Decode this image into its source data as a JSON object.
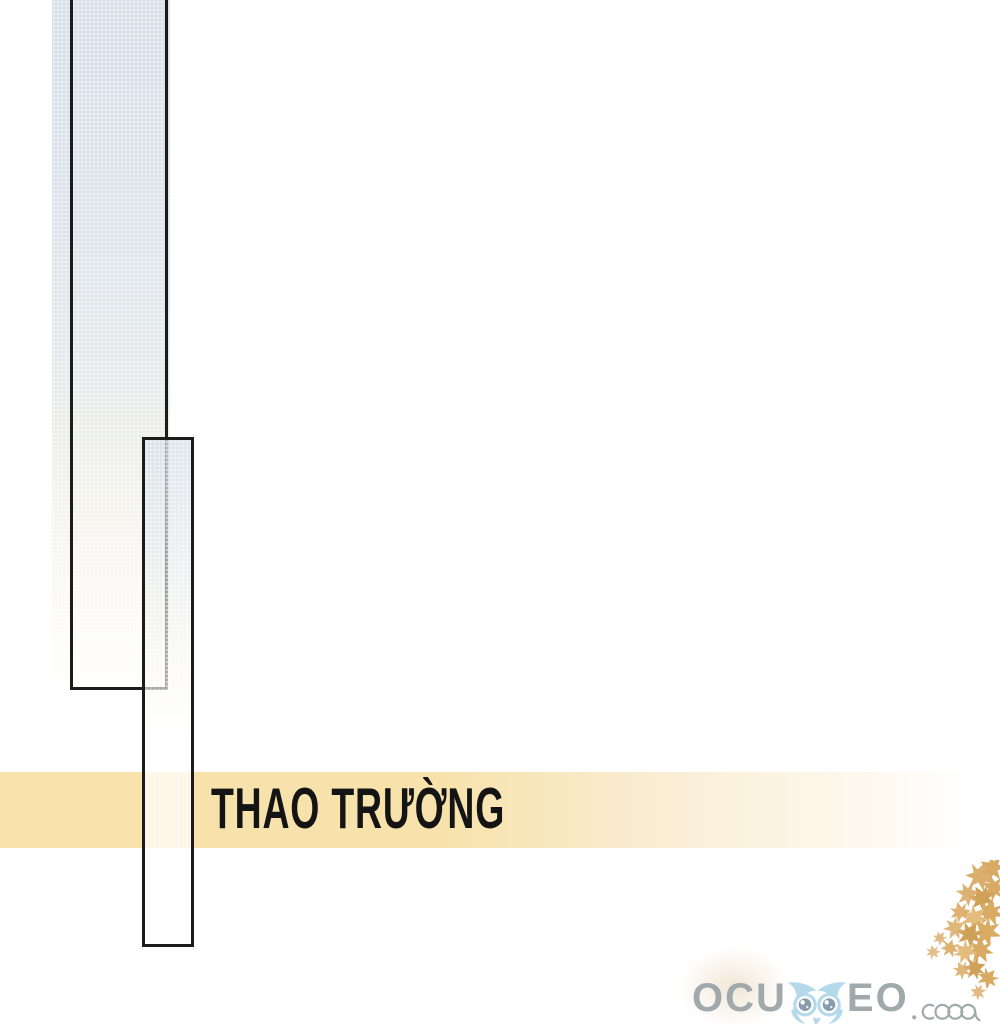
{
  "artwork": {
    "caption": {
      "text": "THAO TRƯỜNG"
    },
    "watermark": {
      "prefix": "OCU",
      "suffix": "EO",
      "tld": ".com"
    },
    "colors": {
      "band_yellow": "#f8e3ad",
      "panel_border": "#1b1b1b",
      "strip_blue": "#d8e0e8",
      "owl_blue": "#aed6ea",
      "owl_pupil": "#7e95a5",
      "logo_gray": "#99a3a6",
      "leaf_gold": "#d9aa64"
    }
  }
}
